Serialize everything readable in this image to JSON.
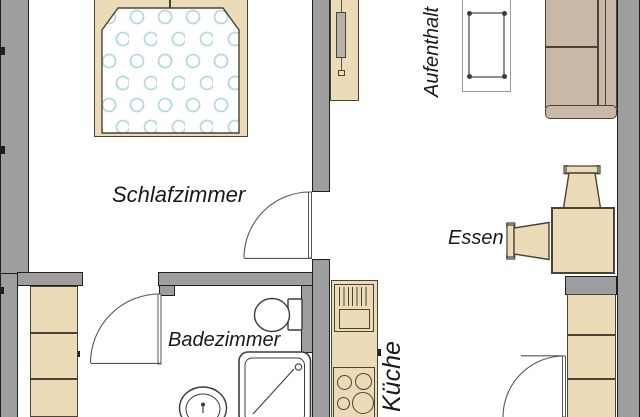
{
  "plan": {
    "kind": "apartment-floor-plan",
    "rooms": {
      "schlafzimmer": {
        "label": "Schlafzimmer"
      },
      "badezimmer": {
        "label": "Badezimmer"
      },
      "kueche": {
        "label": "Küche"
      },
      "essen": {
        "label": "Essen"
      },
      "aufenthalt": {
        "label": "Aufenthalt"
      }
    },
    "furniture": {
      "schlafzimmer": [
        "double-bed"
      ],
      "aufenthalt": [
        "tv-cabinet",
        "coffee-table",
        "sofa"
      ],
      "essen": [
        "dining-table",
        "chair-north",
        "chair-west"
      ],
      "kueche": [
        "counter-with-sink",
        "stove",
        "tall-cabinets"
      ],
      "badezimmer": [
        "toilet",
        "washbasin",
        "shower"
      ],
      "hallway": [
        "wardrobe"
      ]
    },
    "doors": [
      "bedroom-door",
      "bathroom-door",
      "kitchen-door"
    ],
    "colors": {
      "wall": "#9e9e9e",
      "wall_outline": "#1f1f1f",
      "furniture_fill": "#ebdbb6",
      "furniture_outline": "#4a4438",
      "sofa_fill": "#c9b8a6",
      "duvet_dots": "#b3dade",
      "fixture_line": "#3d3d3d",
      "floor": "#ffffff",
      "text": "#1a1a1a"
    }
  }
}
